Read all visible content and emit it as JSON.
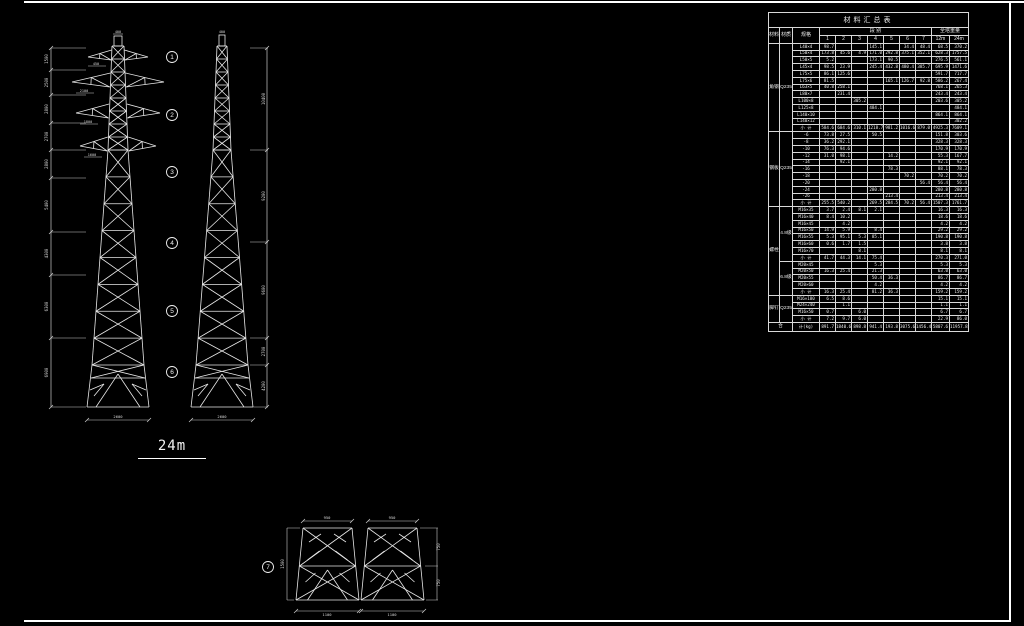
{
  "drawing": {
    "height_label": "24m",
    "section_markers": [
      "1",
      "2",
      "3",
      "4",
      "5",
      "6"
    ],
    "leg_detail_marker": "7",
    "front_tower": {
      "top_dim": "400",
      "arm_dims": [
        "450",
        "2100",
        "1800",
        "1600"
      ],
      "base_dim": "2600",
      "left_dims": [
        "1500",
        "2500",
        "2800",
        "2700",
        "2800",
        "5400",
        "4300",
        "6300",
        "6900"
      ]
    },
    "side_tower": {
      "top_dim": "400",
      "base_dim": "2600",
      "right_dims": [
        "10400",
        "9200",
        "9600",
        "2700",
        "4200"
      ]
    },
    "leg_details": {
      "top_dims": [
        "950",
        "950"
      ],
      "bottom_dims": [
        "1100",
        "1100"
      ],
      "left_dim": "1500",
      "right_dims": [
        "750",
        "750"
      ]
    }
  },
  "table": {
    "title": "材料汇总表",
    "headers": {
      "material": "材料",
      "grade": "材质",
      "spec": "规格",
      "segments": "段 别",
      "weights": "全塔重量",
      "segment_cols": [
        "1",
        "2",
        "3",
        "4",
        "5",
        "6",
        "7"
      ],
      "weight_cols": [
        "12m",
        "24m"
      ]
    },
    "groups": [
      {
        "material": "角钢",
        "grade": "Q235",
        "rows": [
          [
            "L40×4",
            "98.7",
            "",
            "",
            "145.1",
            "",
            "34.4",
            "48.4",
            "68.5",
            "370.2"
          ],
          [
            "L50×4",
            "173.8",
            "45.6",
            "4.9",
            "171.0",
            "292.8",
            "375.1",
            "352.1",
            "628.3",
            "1757.5"
          ],
          [
            "L50×5",
            "5.2",
            "",
            "",
            "173.1",
            "90.5",
            "",
            "",
            "276.5",
            "561.1"
          ],
          [
            "L45×4",
            "98.5",
            "23.9",
            "",
            "245.4",
            "432.8",
            "480.4",
            "385.7",
            "695.9",
            "1471.6"
          ],
          [
            "L75×5",
            "86.1",
            "125.6",
            "",
            "",
            "",
            "",
            "",
            "591.7",
            "717.7"
          ],
          [
            "L75×6",
            "81.5",
            "",
            "",
            "",
            "165.1",
            "126.7",
            "92.8",
            "586.2",
            "267.4"
          ],
          [
            "L63×5",
            "40.8",
            "258.1",
            "",
            "",
            "",
            "",
            "",
            "768.1",
            "265.3"
          ],
          [
            "L80×7",
            "",
            "231.4",
            "",
            "",
            "",
            "",
            "",
            "243.4",
            "243.4"
          ],
          [
            "L100×8",
            "",
            "",
            "305.2",
            "",
            "",
            "",
            "",
            "203.6",
            "305.2"
          ],
          [
            "L125×8",
            "",
            "",
            "",
            "484.1",
            "",
            "",
            "",
            "",
            "484.1"
          ],
          [
            "L140×10",
            "",
            "",
            "",
            "",
            "",
            "",
            "",
            "864.1",
            "864.1"
          ],
          [
            "L140×12",
            "",
            "",
            "",
            "",
            "",
            "",
            "",
            "",
            "302.2"
          ],
          [
            "小 计",
            "584.6",
            "684.6",
            "310.1",
            "1218.7",
            "981.2",
            "1016.6",
            "879.0",
            "4925.3",
            "7609.1"
          ]
        ]
      },
      {
        "material": "钢板",
        "grade": "Q235",
        "rows": [
          [
            "-6",
            "73.8",
            "27.5",
            "",
            "50.5",
            "",
            "",
            "",
            "151.8",
            "303.6"
          ],
          [
            "-8",
            "36.2",
            "292.1",
            "",
            "",
            "",
            "",
            "",
            "328.3",
            "328.3"
          ],
          [
            "-10",
            "76.3",
            "94.6",
            "",
            "",
            "",
            "",
            "",
            "170.9",
            "170.9"
          ],
          [
            "-12",
            "31.0",
            "98.1",
            "",
            "",
            "14.2",
            "",
            "",
            "55.3",
            "167.7"
          ],
          [
            "-14",
            "",
            "92.1",
            "",
            "",
            "",
            "",
            "",
            "92.1",
            "92.1"
          ],
          [
            "-16",
            "",
            "",
            "",
            "",
            "78.3",
            "",
            "",
            "88.1",
            "78.3"
          ],
          [
            "-18",
            "",
            "",
            "",
            "",
            "",
            "70.2",
            "",
            "70.2",
            "70.2"
          ],
          [
            "-20",
            "",
            "",
            "",
            "",
            "",
            "",
            "56.4",
            "56.4",
            "56.4"
          ],
          [
            "-24",
            "",
            "",
            "",
            "280.8",
            "",
            "",
            "",
            "280.8",
            "280.8"
          ],
          [
            "-26",
            "",
            "",
            "",
            "",
            "213.4",
            "",
            "",
            "213.4",
            "213.4"
          ],
          [
            "小 计",
            "255.5",
            "540.2",
            "",
            "269.5",
            "284.5",
            "70.2",
            "56.4",
            "1507.3",
            "1761.7"
          ]
        ]
      },
      {
        "material": "螺栓",
        "grade": "4.8级",
        "rows": [
          [
            "M16×35",
            "3.7",
            "2.4",
            "8.1",
            "2.1",
            "",
            "",
            "",
            "16.3",
            "16.3"
          ],
          [
            "M16×40",
            "8.4",
            "10.2",
            "",
            "",
            "",
            "",
            "",
            "18.6",
            "18.6"
          ],
          [
            "M16×45",
            "",
            "4.2",
            "",
            "",
            "",
            "",
            "",
            "4.2",
            "4.2"
          ],
          [
            "M16×50",
            "14.9",
            "5.9",
            "",
            "8.4",
            "",
            "",
            "",
            "29.2",
            "29.2"
          ],
          [
            "M16×55",
            "5.3",
            "95.1",
            "5.3",
            "85.1",
            "",
            "",
            "",
            "190.8",
            "190.8"
          ],
          [
            "M16×60",
            "0.6",
            "1.7",
            "1.5",
            "",
            "",
            "",
            "",
            "3.8",
            "3.8"
          ],
          [
            "M16×70",
            "",
            "",
            "8.1",
            "",
            "",
            "",
            "",
            "8.1",
            "8.1"
          ],
          [
            "小 计",
            "41.7",
            "44.3",
            "14.1",
            "75.4",
            "",
            "",
            "",
            "270.3",
            "271.0"
          ]
        ]
      },
      {
        "material": "",
        "grade": "6.8级",
        "rows": [
          [
            "M20×45",
            "",
            "",
            "",
            "5.3",
            "",
            "",
            "",
            "5.3",
            "5.3"
          ],
          [
            "M20×50",
            "16.3",
            "25.4",
            "",
            "21.3",
            "",
            "",
            "",
            "63.0",
            "63.0"
          ],
          [
            "M20×55",
            "",
            "",
            "",
            "50.4",
            "36.3",
            "",
            "",
            "86.7",
            "86.7"
          ],
          [
            "M20×60",
            "",
            "",
            "",
            "4.2",
            "",
            "",
            "",
            "4.2",
            "4.2"
          ],
          [
            "小 计",
            "16.3",
            "25.4",
            "",
            "81.2",
            "36.3",
            "",
            "",
            "159.2",
            "159.2"
          ]
        ]
      },
      {
        "material": "脚钉",
        "grade": "Q235",
        "rows": [
          [
            "M16×180",
            "6.5",
            "8.6",
            "",
            "",
            "",
            "",
            "",
            "15.1",
            "15.1"
          ],
          [
            "M24×240",
            "",
            "1.1",
            "",
            "",
            "",
            "",
            "",
            "1.1",
            "1.1"
          ],
          [
            "M16×50",
            "0.7",
            "",
            "6.0",
            "",
            "",
            "",
            "",
            "6.7",
            "6.7"
          ],
          [
            "小 计",
            "7.2",
            "9.7",
            "6.0",
            "",
            "",
            "",
            "",
            "22.9",
            "86.0"
          ]
        ]
      }
    ],
    "total_row": [
      "合",
      "计(kg)",
      "891.7",
      "1840.6",
      "898.8",
      "941.4",
      "193.8",
      "3075.6",
      "1456.4",
      "5807.6",
      "11957.8"
    ]
  }
}
